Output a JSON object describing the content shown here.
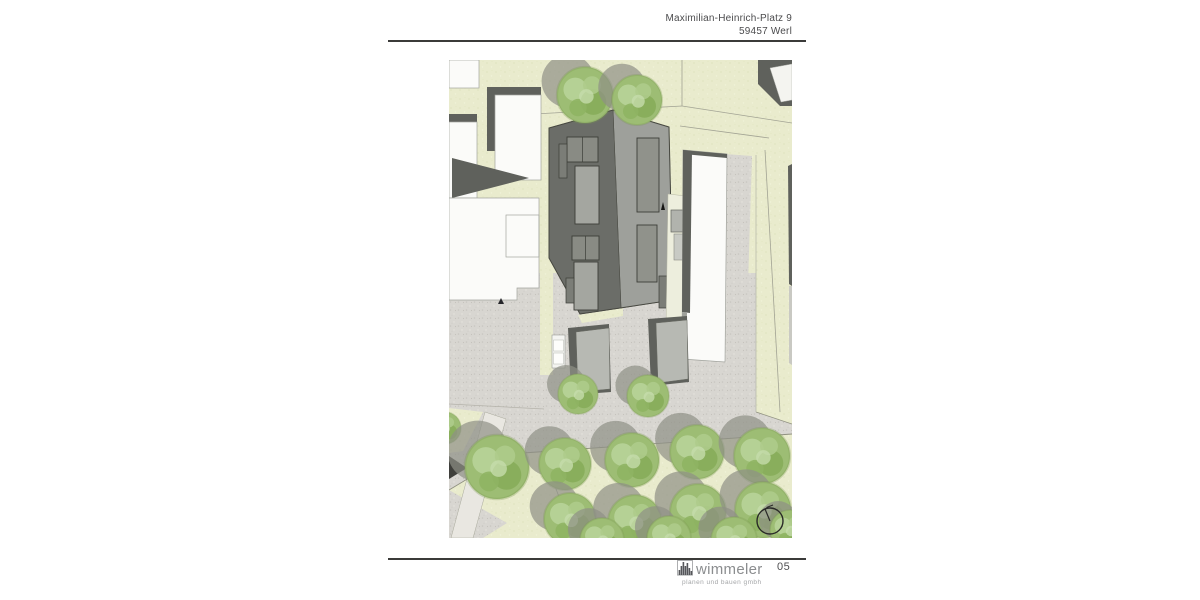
{
  "header": {
    "address_line1": "Maximilian-Heinrich-Platz 9",
    "address_line2": "59457 Werl"
  },
  "footer": {
    "brand": "wimmeler",
    "tagline": "planen und bauen gmbh",
    "page_number": "05"
  },
  "site_plan": {
    "colors": {
      "grass": "#e9ebcd",
      "grass-dot": "#dfe2bd",
      "pave": "#d8d6d1",
      "pave-dot": "#c7c5bf",
      "dark-roof": "#5f615c",
      "bldg-dark": "#6b6d68",
      "bldg-light": "#9ea09b",
      "white-bldg": "#fbfbf9",
      "tree-base": "#9dbd74",
      "tree-shadow": "#8e9086",
      "line": "#a2a394",
      "ink": "#2a2a28"
    }
  }
}
